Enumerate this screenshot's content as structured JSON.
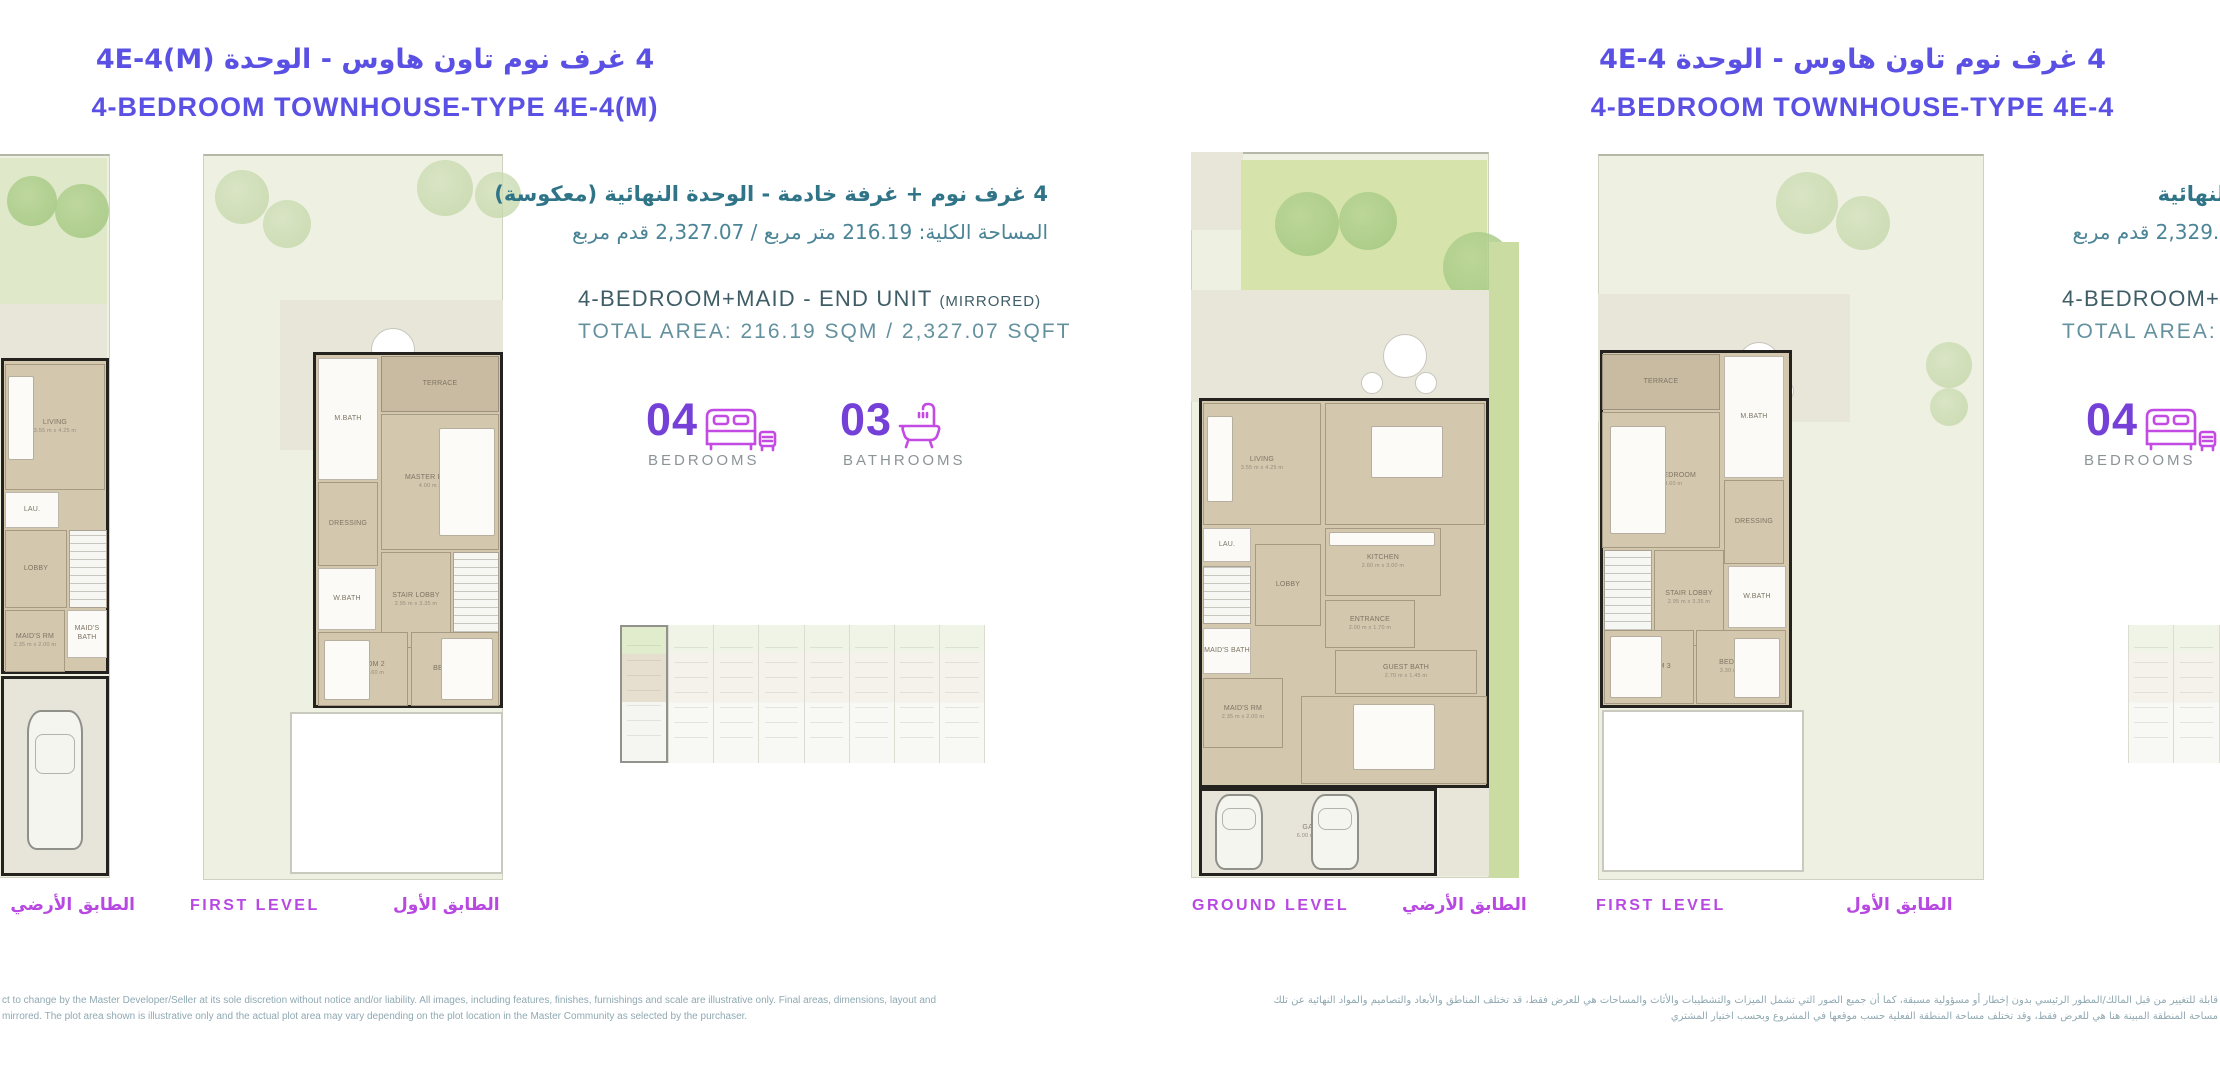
{
  "left": {
    "title_ar": "4 غرف نوم تاون هاوس - الوحدة 4E-4(M)",
    "title_en": "4-BEDROOM TOWNHOUSE-TYPE 4E-4(M)",
    "info_ar_1": "4 غرف نوم + غرفة خادمة - الوحدة النهائية (معكوسة)",
    "info_ar_2": "المساحة الكلية: 216.19 متر مربع / 2,327.07 قدم مربع",
    "info_en_1": "4-BEDROOM+MAID - END UNIT",
    "info_en_1_suffix": "(MIRRORED)",
    "info_en_2": "TOTAL AREA: 216.19 SQM / 2,327.07 SQFT",
    "stats": {
      "bedrooms_value": "04",
      "bedrooms_label": "BEDROOMS",
      "bathrooms_value": "03",
      "bathrooms_label": "BATHROOMS"
    },
    "levels": {
      "ground_ar": "الطابق الأرضي",
      "first_en": "FIRST LEVEL",
      "first_ar": "الطابق الأول"
    },
    "disclaimer_line1": "ct to change by the Master Developer/Seller at its sole discretion without notice and/or liability. All images, including features, finishes, furnishings and scale are illustrative only. Final areas, dimensions, layout and",
    "disclaimer_line2": "mirrored. The plot area shown is illustrative only and the actual plot area may vary depending on the plot location in the Master Community as selected by the purchaser."
  },
  "right": {
    "title_ar": "4 غرف نوم تاون هاوس - الوحدة 4E-4",
    "title_en": "4-BEDROOM TOWNHOUSE-TYPE 4E-4",
    "info_ar_1_fragment": "لنهائية",
    "info_ar_2_fragment": "2,329.9 قدم مربع",
    "info_en_1_fragment": "4-BEDROOM+M",
    "info_en_2_fragment": "TOTAL AREA: 2",
    "stats": {
      "bedrooms_value": "04",
      "bedrooms_label": "BEDROOMS"
    },
    "levels": {
      "ground_en": "GROUND LEVEL",
      "ground_ar": "الطابق الأرضي",
      "first_en": "FIRST LEVEL",
      "first_ar": "الطابق الأول"
    },
    "disclaimer_line1": "قابلة للتغيير من قبل المالك/المطور الرئيسي بدون إخطار أو مسؤولية مسبقة، كما أن جميع الصور التي تشمل الميزات والتشطيبات والأثاث والمساحات هي للعرض فقط، قد تختلف المناطق والأبعاد والتصاميم والمواد النهائية عن تلك",
    "disclaimer_line2": "مساحة المنطقة المبينة هنا هي للعرض فقط، وقد تختلف مساحة المنطقة الفعلية حسب موقعها في المشروع وبحسب اختيار المشتري"
  },
  "icon_colors": {
    "stat_icon_stroke": "#c44ae4",
    "title_purple": "#5a50e4",
    "level_magenta": "#b848e2",
    "stat_number_purple": "#7440d8",
    "teal_text": "#4a8496"
  },
  "plans": [
    {
      "id": "left-ground-cut",
      "x": -225,
      "y": 150,
      "w": 343,
      "h": 732,
      "elements": [
        {
          "t": "rect",
          "cls": "plot",
          "x": 8,
          "y": 4,
          "w": 327,
          "h": 724,
          "name": "plot-boundary"
        },
        {
          "t": "rect",
          "cls": "lawn-pale",
          "x": 222,
          "y": 8,
          "w": 110,
          "h": 146,
          "name": "garden"
        },
        {
          "t": "tree",
          "x": 232,
          "y": 26,
          "d": 50
        },
        {
          "t": "tree",
          "x": 280,
          "y": 34,
          "d": 54
        },
        {
          "t": "rect",
          "cls": "patio",
          "x": 222,
          "y": 154,
          "w": 110,
          "h": 54,
          "name": "patio"
        },
        {
          "t": "rect",
          "cls": "building",
          "x": 226,
          "y": 208,
          "w": 108,
          "h": 316,
          "name": "building-outline"
        },
        {
          "t": "rect",
          "cls": "tan",
          "x": 230,
          "y": 214,
          "w": 100,
          "h": 126,
          "label": "LIVING",
          "dim": "3.55 m x 4.25 m"
        },
        {
          "t": "rect",
          "cls": "furn",
          "x": 233,
          "y": 226,
          "w": 26,
          "h": 84,
          "name": "sofa"
        },
        {
          "t": "rect",
          "cls": "white",
          "x": 230,
          "y": 342,
          "w": 54,
          "h": 36,
          "label": "LAU."
        },
        {
          "t": "rect",
          "cls": "tan",
          "x": 230,
          "y": 380,
          "w": 62,
          "h": 78,
          "label": "LOBBY"
        },
        {
          "t": "rect",
          "cls": "stairs",
          "x": 294,
          "y": 380,
          "w": 38,
          "h": 78,
          "name": "stairs"
        },
        {
          "t": "rect",
          "cls": "white",
          "x": 292,
          "y": 460,
          "w": 40,
          "h": 48,
          "label": "MAID'S BATH"
        },
        {
          "t": "rect",
          "cls": "tan",
          "x": 230,
          "y": 460,
          "w": 60,
          "h": 62,
          "label": "MAID'S RM",
          "dim": "2.35 m x 2.00 m"
        },
        {
          "t": "rect",
          "cls": "garage",
          "x": 226,
          "y": 526,
          "w": 108,
          "h": 200,
          "label": "GARAGE",
          "name": "room-garage"
        },
        {
          "t": "car",
          "x": 252,
          "y": 560,
          "w": 56,
          "h": 140
        }
      ]
    },
    {
      "id": "left-first",
      "x": 185,
      "y": 148,
      "w": 335,
      "h": 734,
      "elements": [
        {
          "t": "rect",
          "cls": "plot",
          "x": 18,
          "y": 6,
          "w": 300,
          "h": 726,
          "name": "plot-boundary"
        },
        {
          "t": "tree",
          "x": 30,
          "y": 22,
          "d": 54,
          "pale": true
        },
        {
          "t": "tree",
          "x": 78,
          "y": 52,
          "d": 48,
          "pale": true
        },
        {
          "t": "tree",
          "x": 232,
          "y": 12,
          "d": 56,
          "pale": true
        },
        {
          "t": "tree",
          "x": 290,
          "y": 24,
          "d": 46,
          "pale": true
        },
        {
          "t": "rect",
          "cls": "patio",
          "x": 95,
          "y": 152,
          "w": 223,
          "h": 150,
          "name": "patio"
        },
        {
          "t": "round",
          "x": 186,
          "y": 180,
          "d": 44,
          "name": "patio-table"
        },
        {
          "t": "round",
          "x": 163,
          "y": 220,
          "d": 24,
          "name": "patio-chair"
        },
        {
          "t": "round",
          "x": 221,
          "y": 222,
          "d": 24,
          "name": "patio-chair"
        },
        {
          "t": "rect",
          "cls": "building",
          "x": 128,
          "y": 204,
          "w": 190,
          "h": 356,
          "name": "building-outline"
        },
        {
          "t": "rect",
          "cls": "white",
          "x": 133,
          "y": 210,
          "w": 60,
          "h": 122,
          "label": "M.BATH"
        },
        {
          "t": "rect",
          "cls": "terrace",
          "x": 196,
          "y": 208,
          "w": 118,
          "h": 56,
          "label": "TERRACE"
        },
        {
          "t": "rect",
          "cls": "tan",
          "x": 196,
          "y": 266,
          "w": 118,
          "h": 136,
          "label": "MASTER BEDROOM",
          "dim": "4.00 m x 3.60 m"
        },
        {
          "t": "rect",
          "cls": "furn",
          "x": 254,
          "y": 280,
          "w": 56,
          "h": 108,
          "name": "bed"
        },
        {
          "t": "rect",
          "cls": "tan",
          "x": 133,
          "y": 334,
          "w": 60,
          "h": 84,
          "label": "DRESSING"
        },
        {
          "t": "rect",
          "cls": "tan",
          "x": 196,
          "y": 404,
          "w": 70,
          "h": 96,
          "label": "STAIR LOBBY",
          "dim": "2.95 m x 3.35 m"
        },
        {
          "t": "rect",
          "cls": "stairs",
          "x": 268,
          "y": 404,
          "w": 46,
          "h": 96,
          "name": "stairs"
        },
        {
          "t": "rect",
          "cls": "white",
          "x": 133,
          "y": 420,
          "w": 58,
          "h": 62,
          "label": "W.BATH"
        },
        {
          "t": "rect",
          "cls": "tan",
          "x": 133,
          "y": 484,
          "w": 90,
          "h": 74,
          "label": "BEDROOM 2",
          "dim": "3.30 m x 3.60 m"
        },
        {
          "t": "rect",
          "cls": "furn",
          "x": 139,
          "y": 492,
          "w": 46,
          "h": 60,
          "name": "bed"
        },
        {
          "t": "rect",
          "cls": "tan",
          "x": 226,
          "y": 484,
          "w": 88,
          "h": 74,
          "label": "BEDROOM 3"
        },
        {
          "t": "rect",
          "cls": "furn",
          "x": 256,
          "y": 490,
          "w": 52,
          "h": 62,
          "name": "bed"
        },
        {
          "t": "rect",
          "cls": "void",
          "x": 105,
          "y": 564,
          "w": 213,
          "h": 162,
          "name": "open-below"
        }
      ]
    },
    {
      "id": "right-ground",
      "x": 1185,
      "y": 148,
      "w": 340,
      "h": 734,
      "elements": [
        {
          "t": "rect",
          "cls": "plot",
          "x": 6,
          "y": 4,
          "w": 298,
          "h": 726,
          "name": "plot-boundary"
        },
        {
          "t": "rect",
          "cls": "patio",
          "x": 6,
          "y": 4,
          "w": 52,
          "h": 78,
          "name": "front-path"
        },
        {
          "t": "rect",
          "cls": "lawn",
          "x": 56,
          "y": 12,
          "w": 246,
          "h": 130,
          "name": "lawn"
        },
        {
          "t": "tree",
          "x": 90,
          "y": 44,
          "d": 64
        },
        {
          "t": "tree",
          "x": 154,
          "y": 44,
          "d": 58
        },
        {
          "t": "tree",
          "x": 258,
          "y": 84,
          "d": 70
        },
        {
          "t": "rect",
          "cls": "patio",
          "x": 6,
          "y": 142,
          "w": 298,
          "h": 112,
          "name": "patio"
        },
        {
          "t": "round",
          "x": 198,
          "y": 186,
          "d": 44,
          "name": "patio-table"
        },
        {
          "t": "round",
          "x": 176,
          "y": 224,
          "d": 22,
          "name": "patio-chair"
        },
        {
          "t": "round",
          "x": 230,
          "y": 224,
          "d": 22,
          "name": "patio-chair"
        },
        {
          "t": "rect",
          "cls": "strip",
          "x": 304,
          "y": 94,
          "w": 30,
          "h": 636,
          "name": "side-garden-strip"
        },
        {
          "t": "rect",
          "cls": "building",
          "x": 14,
          "y": 250,
          "w": 290,
          "h": 390,
          "name": "building-outline"
        },
        {
          "t": "rect",
          "cls": "tan",
          "x": 18,
          "y": 255,
          "w": 118,
          "h": 122,
          "label": "LIVING",
          "dim": "3.55 m x 4.25 m"
        },
        {
          "t": "rect",
          "cls": "furn",
          "x": 22,
          "y": 268,
          "w": 26,
          "h": 86,
          "name": "sofa"
        },
        {
          "t": "rect",
          "cls": "tan",
          "x": 140,
          "y": 255,
          "w": 160,
          "h": 122,
          "label": "DINING",
          "dim": "3.50 m x 2.95 m"
        },
        {
          "t": "rect",
          "cls": "furn",
          "x": 186,
          "y": 278,
          "w": 72,
          "h": 52,
          "name": "dining-table"
        },
        {
          "t": "rect",
          "cls": "tan",
          "x": 140,
          "y": 380,
          "w": 116,
          "h": 68,
          "label": "KITCHEN",
          "dim": "2.60 m x 3.00 m"
        },
        {
          "t": "rect",
          "cls": "furn",
          "x": 144,
          "y": 384,
          "w": 106,
          "h": 14,
          "name": "kitchen-counter"
        },
        {
          "t": "rect",
          "cls": "white",
          "x": 18,
          "y": 380,
          "w": 48,
          "h": 34,
          "label": "LAU."
        },
        {
          "t": "rect",
          "cls": "stairs",
          "x": 18,
          "y": 418,
          "w": 48,
          "h": 58,
          "name": "stairs"
        },
        {
          "t": "rect",
          "cls": "tan",
          "x": 70,
          "y": 396,
          "w": 66,
          "h": 82,
          "label": "LOBBY"
        },
        {
          "t": "rect",
          "cls": "tan",
          "x": 140,
          "y": 452,
          "w": 90,
          "h": 48,
          "label": "ENTRANCE",
          "dim": "2.00 m x 1.70 m"
        },
        {
          "t": "rect",
          "cls": "white",
          "x": 18,
          "y": 480,
          "w": 48,
          "h": 46,
          "label": "MAID'S BATH"
        },
        {
          "t": "rect",
          "cls": "tan",
          "x": 18,
          "y": 530,
          "w": 80,
          "h": 70,
          "label": "MAID'S RM",
          "dim": "2.35 m x 2.00 m"
        },
        {
          "t": "rect",
          "cls": "tan",
          "x": 150,
          "y": 502,
          "w": 142,
          "h": 44,
          "label": "GUEST BATH",
          "dim": "2.70 m x 1.45 m"
        },
        {
          "t": "rect",
          "cls": "tan",
          "x": 116,
          "y": 548,
          "w": 186,
          "h": 88,
          "label": "GUEST ROOM",
          "dim": "4.20 m x 3.00 m"
        },
        {
          "t": "rect",
          "cls": "furn",
          "x": 168,
          "y": 556,
          "w": 82,
          "h": 66,
          "name": "bed"
        },
        {
          "t": "rect",
          "cls": "garage",
          "x": 14,
          "y": 640,
          "w": 238,
          "h": 88,
          "label": "GARAGE",
          "dim": "6.00 m x 5.40 m",
          "name": "room-garage"
        },
        {
          "t": "car",
          "x": 30,
          "y": 646,
          "w": 48,
          "h": 76
        },
        {
          "t": "car",
          "x": 126,
          "y": 646,
          "w": 48,
          "h": 76
        },
        {
          "t": "rect",
          "cls": "patio",
          "x": 254,
          "y": 640,
          "w": 50,
          "h": 88,
          "name": "driveway"
        }
      ]
    },
    {
      "id": "right-first",
      "x": 1590,
      "y": 148,
      "w": 400,
      "h": 734,
      "elements": [
        {
          "t": "rect",
          "cls": "plot",
          "x": 8,
          "y": 6,
          "w": 386,
          "h": 726,
          "name": "plot-boundary"
        },
        {
          "t": "tree",
          "x": 186,
          "y": 24,
          "d": 62,
          "pale": true
        },
        {
          "t": "tree",
          "x": 246,
          "y": 48,
          "d": 54,
          "pale": true
        },
        {
          "t": "tree",
          "x": 336,
          "y": 194,
          "d": 46,
          "pale": true
        },
        {
          "t": "tree",
          "x": 340,
          "y": 240,
          "d": 38,
          "pale": true
        },
        {
          "t": "rect",
          "cls": "patio",
          "x": 8,
          "y": 146,
          "w": 252,
          "h": 128,
          "name": "patio"
        },
        {
          "t": "round",
          "x": 148,
          "y": 194,
          "d": 42,
          "name": "patio-table"
        },
        {
          "t": "round",
          "x": 128,
          "y": 232,
          "d": 22,
          "name": "patio-chair"
        },
        {
          "t": "round",
          "x": 182,
          "y": 232,
          "d": 22,
          "name": "patio-chair"
        },
        {
          "t": "rect",
          "cls": "building",
          "x": 10,
          "y": 202,
          "w": 192,
          "h": 358,
          "name": "building-outline"
        },
        {
          "t": "rect",
          "cls": "terrace",
          "x": 12,
          "y": 206,
          "w": 118,
          "h": 56,
          "label": "TERRACE"
        },
        {
          "t": "rect",
          "cls": "tan",
          "x": 12,
          "y": 264,
          "w": 118,
          "h": 136,
          "label": "MASTER BEDROOM",
          "dim": "4.00 m x 3.60 m"
        },
        {
          "t": "rect",
          "cls": "furn",
          "x": 20,
          "y": 278,
          "w": 56,
          "h": 108,
          "name": "bed"
        },
        {
          "t": "rect",
          "cls": "white",
          "x": 134,
          "y": 208,
          "w": 60,
          "h": 122,
          "label": "M.BATH"
        },
        {
          "t": "rect",
          "cls": "tan",
          "x": 134,
          "y": 332,
          "w": 60,
          "h": 84,
          "label": "DRESSING"
        },
        {
          "t": "rect",
          "cls": "tan",
          "x": 64,
          "y": 402,
          "w": 70,
          "h": 96,
          "label": "STAIR LOBBY",
          "dim": "2.95 m x 3.35 m"
        },
        {
          "t": "rect",
          "cls": "stairs",
          "x": 14,
          "y": 402,
          "w": 48,
          "h": 96,
          "name": "stairs"
        },
        {
          "t": "rect",
          "cls": "white",
          "x": 138,
          "y": 418,
          "w": 58,
          "h": 62,
          "label": "W.BATH"
        },
        {
          "t": "rect",
          "cls": "tan",
          "x": 106,
          "y": 482,
          "w": 90,
          "h": 74,
          "label": "BEDROOM 2",
          "dim": "3.30 m x 3.60 m"
        },
        {
          "t": "rect",
          "cls": "furn",
          "x": 144,
          "y": 490,
          "w": 46,
          "h": 60,
          "name": "bed"
        },
        {
          "t": "rect",
          "cls": "tan",
          "x": 14,
          "y": 482,
          "w": 90,
          "h": 74,
          "label": "BEDROOM 3"
        },
        {
          "t": "rect",
          "cls": "furn",
          "x": 20,
          "y": 488,
          "w": 52,
          "h": 62,
          "name": "bed"
        },
        {
          "t": "rect",
          "cls": "void",
          "x": 12,
          "y": 562,
          "w": 202,
          "h": 162,
          "name": "open-below"
        }
      ]
    }
  ],
  "keyplans": [
    {
      "id": "left-key",
      "x": 620,
      "y": 625,
      "w": 365,
      "h": 138,
      "units": 8,
      "highlight": "left"
    },
    {
      "id": "right-key",
      "x": 2128,
      "y": 625,
      "w": 365,
      "h": 138,
      "units": 8,
      "highlight": "right"
    }
  ]
}
